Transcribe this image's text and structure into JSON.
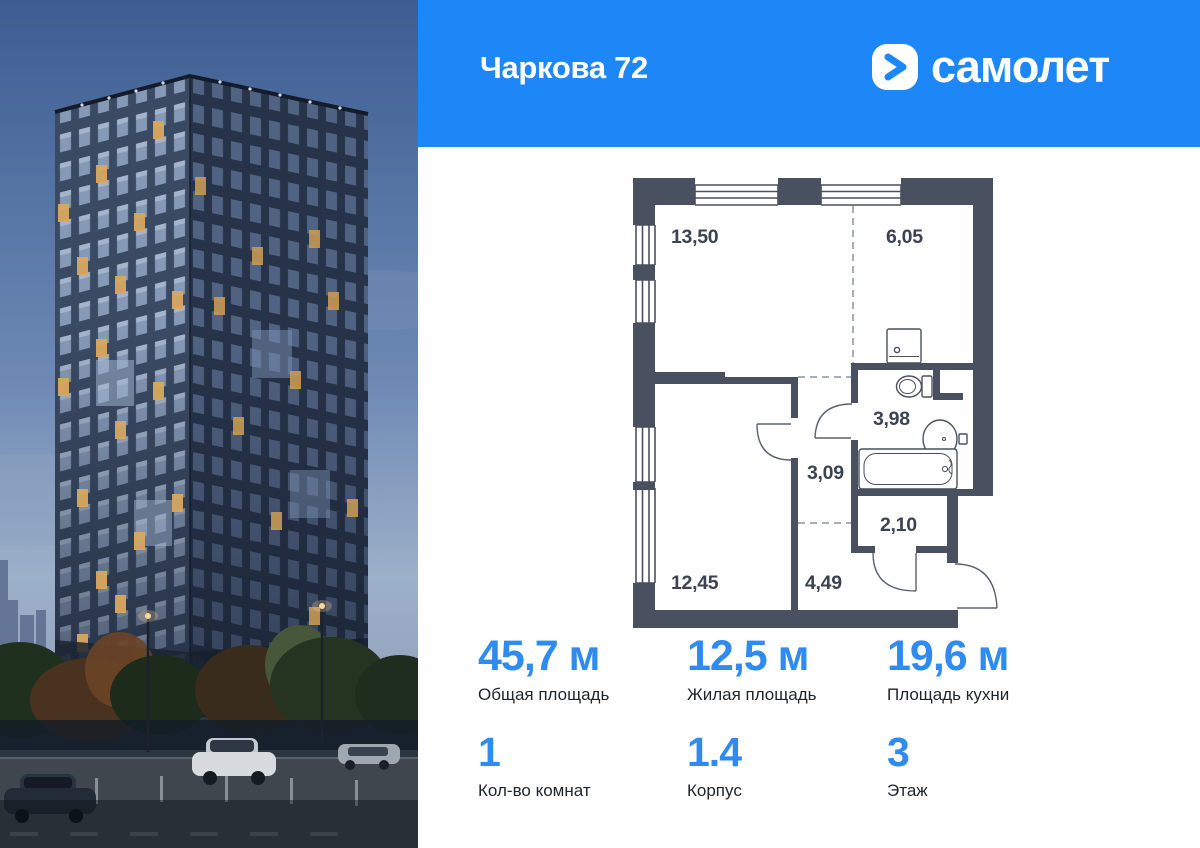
{
  "header": {
    "title": "Чаркова 72",
    "brand": "самолет"
  },
  "plan": {
    "rooms": [
      {
        "name": "living-kitchen",
        "area": "13,50"
      },
      {
        "name": "kitchen-zone",
        "area": "6,05"
      },
      {
        "name": "bathroom",
        "area": "3,98"
      },
      {
        "name": "hallway",
        "area": "3,09"
      },
      {
        "name": "wardrobe",
        "area": "2,10"
      },
      {
        "name": "bedroom",
        "area": "12,45"
      },
      {
        "name": "entry-hall",
        "area": "4,49"
      }
    ]
  },
  "stats": {
    "primary": [
      {
        "value": "45,7 м",
        "label": "Общая площадь"
      },
      {
        "value": "12,5 м",
        "label": "Жилая площадь"
      },
      {
        "value": "19,6 м",
        "label": "Площадь кухни"
      }
    ],
    "secondary": [
      {
        "value": "1",
        "label": "Кол-во комнат"
      },
      {
        "value": "1.4",
        "label": "Корпус"
      },
      {
        "value": "3",
        "label": "Этаж"
      }
    ]
  },
  "colors": {
    "header_blue": "#1e87f8",
    "accent_blue": "#2f8bef",
    "wall": "#49505f"
  }
}
